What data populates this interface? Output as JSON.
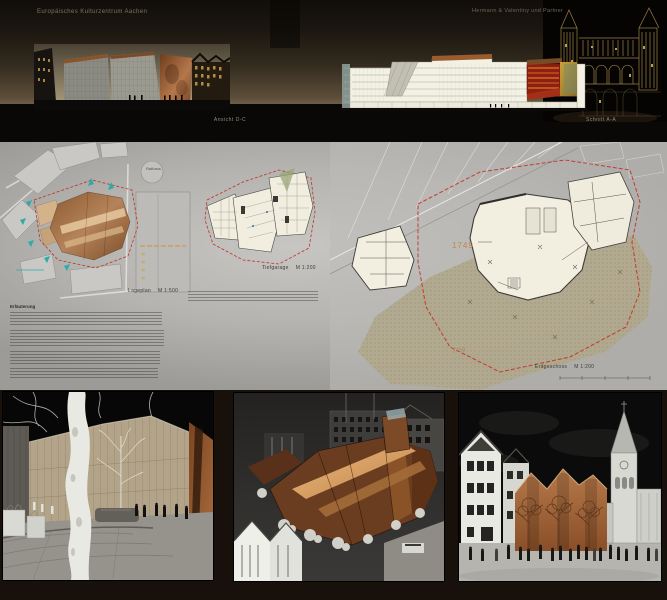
{
  "header": {
    "project_title": "Europäisches Kulturzentrum Aachen",
    "architect": "Hermann & Valentiny und Partner",
    "caption_elevation": "Ansicht D-C",
    "caption_section": "Schnitt A-A"
  },
  "plans": {
    "site": {
      "label": "Lageplan",
      "scale": "M 1:500",
      "rathaus": "Rathaus"
    },
    "garage": {
      "label": "Tiefgarage",
      "scale": "M 1:200"
    },
    "ground": {
      "label": "Erdgeschoss",
      "scale": "M 1:200",
      "year_top": "1749",
      "year_bottom": "1759"
    }
  },
  "notes": {
    "heading": "Erläuterung"
  },
  "colors": {
    "copper": "#a0663a",
    "copper_light": "#e0b184",
    "panel_gray": "#b5b4b0",
    "boundary_red": "#c23026",
    "accent_cyan": "#2aacaa",
    "gothic_gold": "#b0914f",
    "plan_cream": "#f1eedf"
  }
}
